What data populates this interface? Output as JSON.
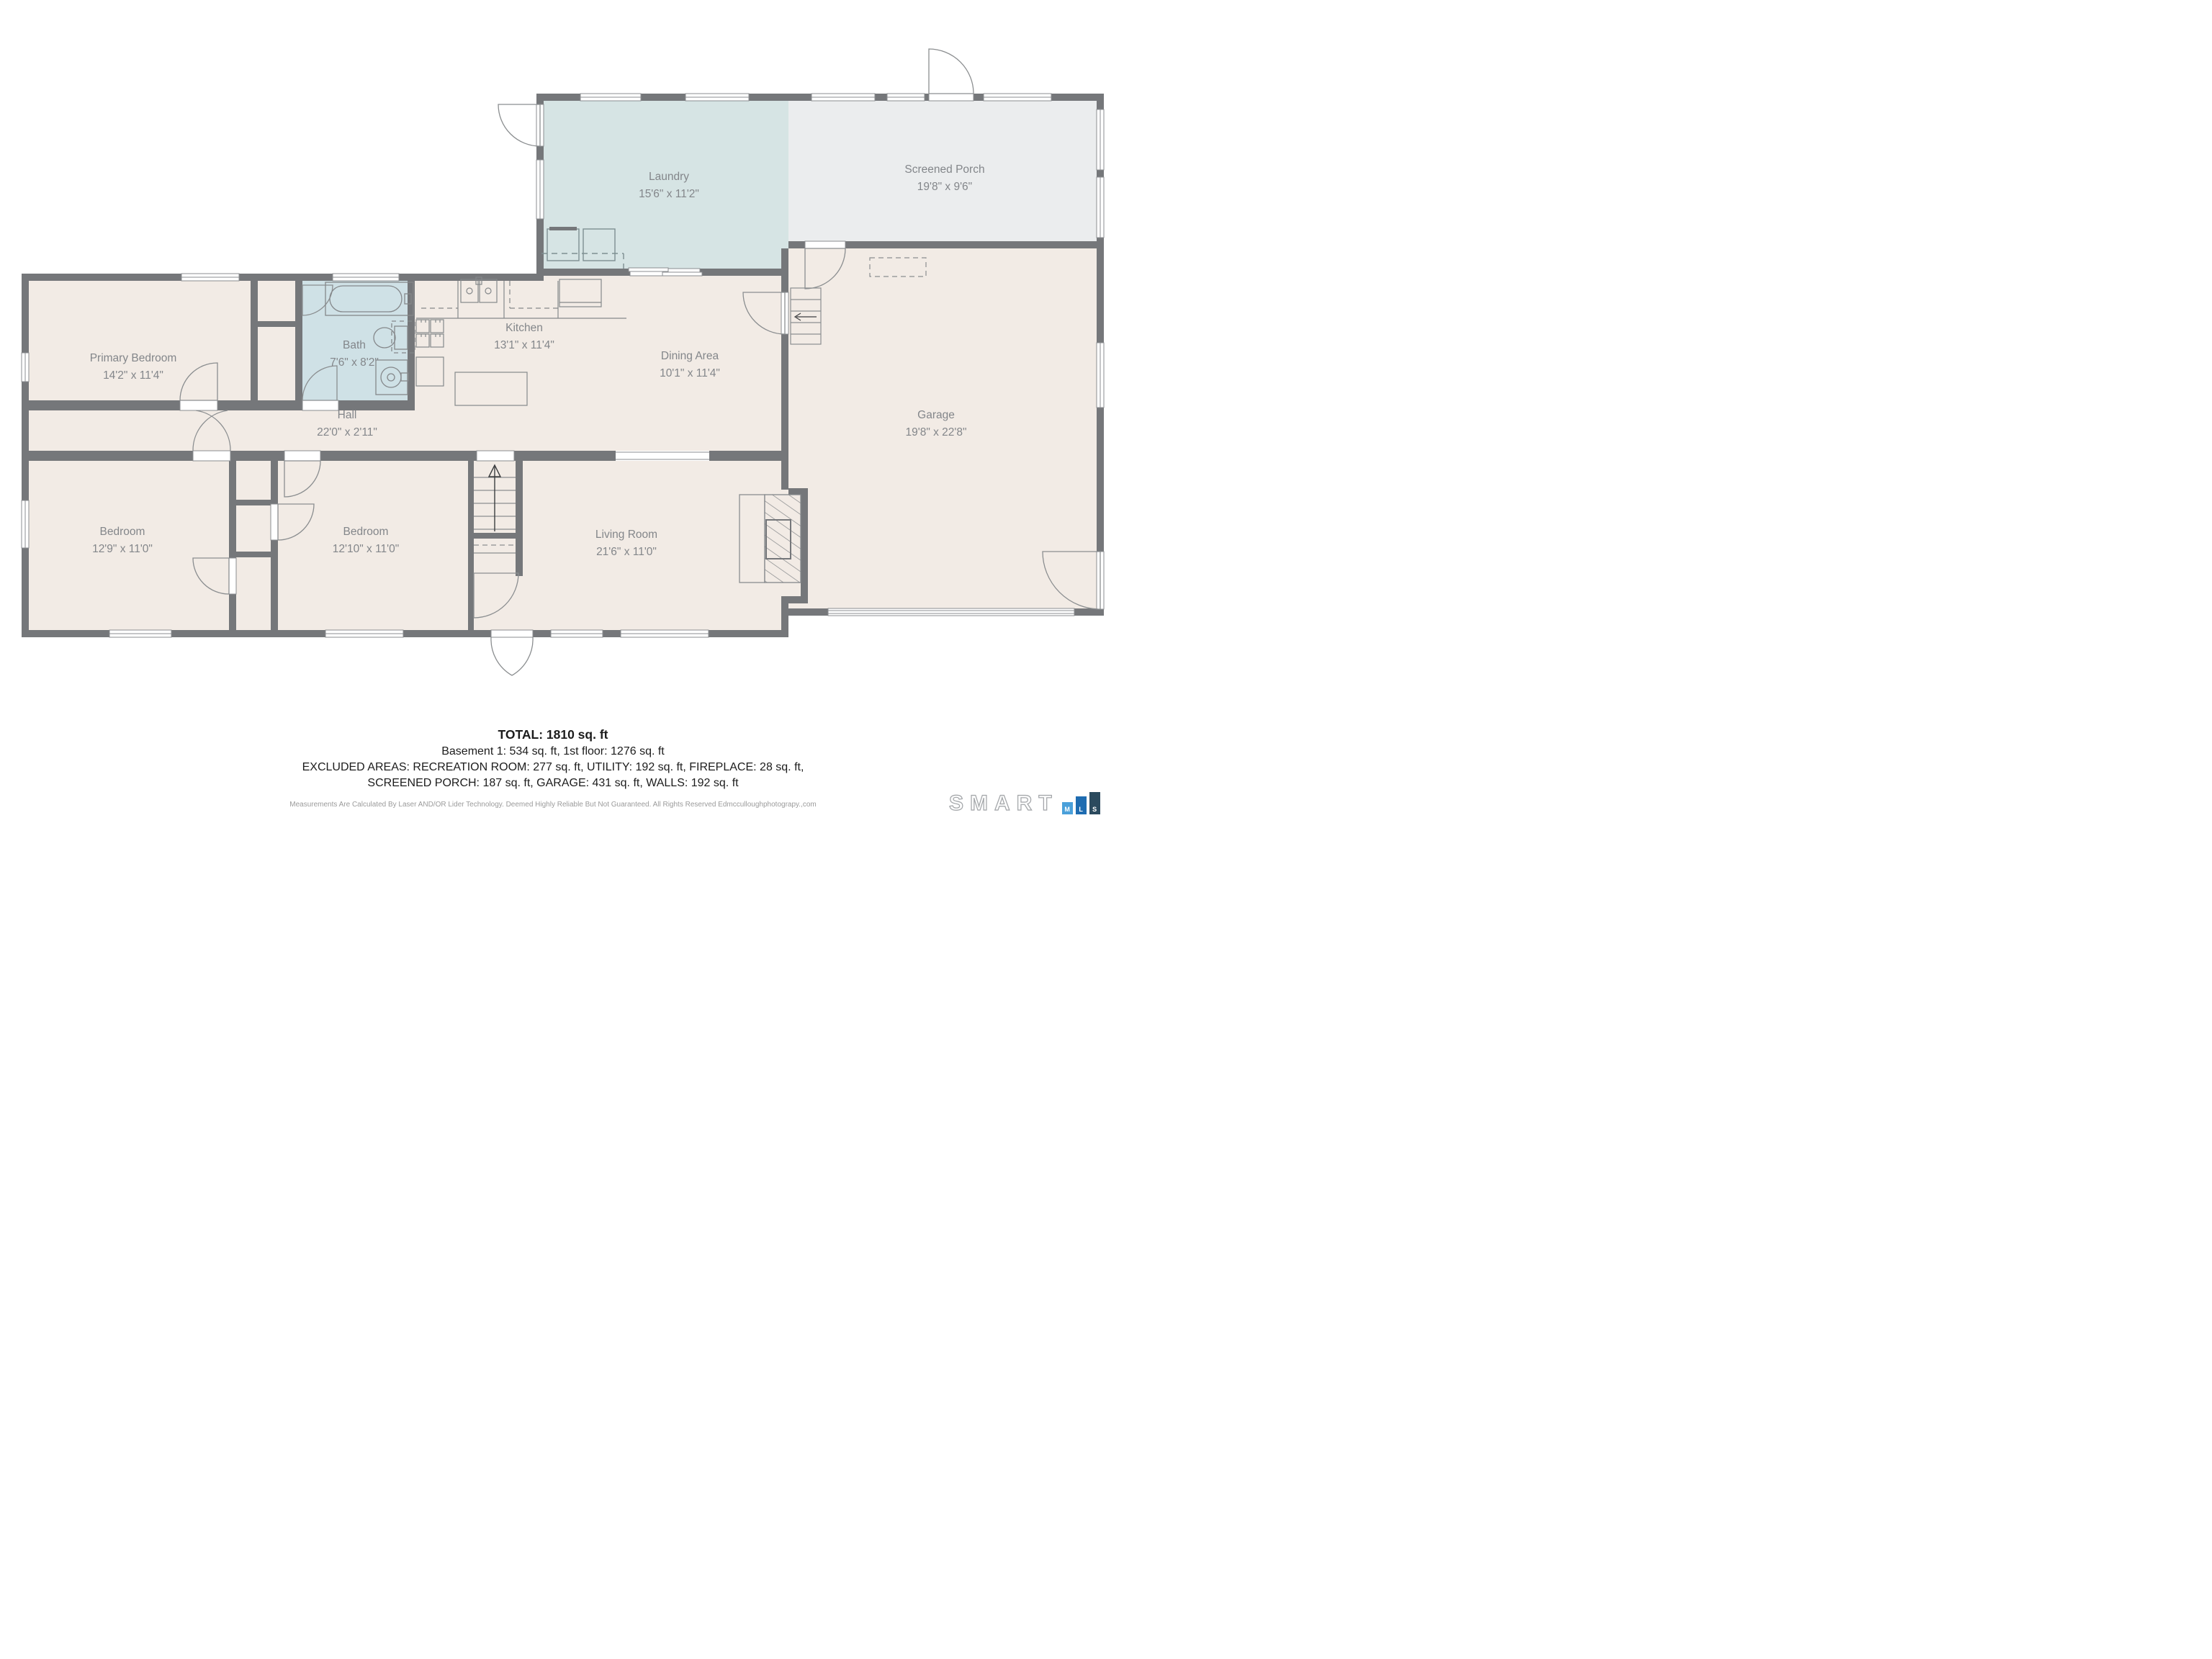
{
  "rooms": [
    {
      "id": "laundry",
      "name": "Laundry",
      "dims": "15'6\" x 11'2\""
    },
    {
      "id": "screened-porch",
      "name": "Screened Porch",
      "dims": "19'8\" x 9'6\""
    },
    {
      "id": "primary-bedroom",
      "name": "Primary Bedroom",
      "dims": "14'2\" x 11'4\""
    },
    {
      "id": "bath",
      "name": "Bath",
      "dims": "7'6\" x 8'2\""
    },
    {
      "id": "kitchen",
      "name": "Kitchen",
      "dims": "13'1\" x 11'4\""
    },
    {
      "id": "dining-area",
      "name": "Dining Area",
      "dims": "10'1\" x 11'4\""
    },
    {
      "id": "garage",
      "name": "Garage",
      "dims": "19'8\" x 22'8\""
    },
    {
      "id": "hall",
      "name": "Hall",
      "dims": "22'0\" x 2'11\""
    },
    {
      "id": "bedroom-left",
      "name": "Bedroom",
      "dims": "12'9\" x 11'0\""
    },
    {
      "id": "bedroom-center",
      "name": "Bedroom",
      "dims": "12'10\" x 11'0\""
    },
    {
      "id": "living-room",
      "name": "Living Room",
      "dims": "21'6\" x 11'0\""
    }
  ],
  "summary": {
    "total": "TOTAL: 1810 sq. ft",
    "line2": "Basement 1: 534 sq. ft, 1st floor: 1276 sq. ft",
    "line3": "EXCLUDED AREAS: RECREATION ROOM: 277 sq. ft, UTILITY: 192 sq. ft, FIREPLACE: 28 sq. ft,",
    "line4": "SCREENED PORCH: 187 sq. ft, GARAGE: 431 sq. ft, WALLS: 192 sq. ft"
  },
  "disclaimer": "Measurements Are Calculated By Laser AND/OR Lider Technology. Deemed Highly Reliable But Not Guaranteed. All Rights Reserved Edmcculloughphotograpy.,com",
  "logo": {
    "brand": "SMART",
    "letters": [
      "M",
      "L",
      "S"
    ]
  },
  "colors": {
    "wall": "#75777a",
    "floor-beige": "#f2ebe5",
    "laundry-blue": "#d6e4e4",
    "bath-blue": "#cfe1e6",
    "porch-gray": "#ebedee",
    "line": "#8b8e90",
    "label": "#83868a",
    "logo-m": "#4aa0da",
    "logo-l": "#1e6cb1",
    "logo-s": "#2b4a5e"
  }
}
